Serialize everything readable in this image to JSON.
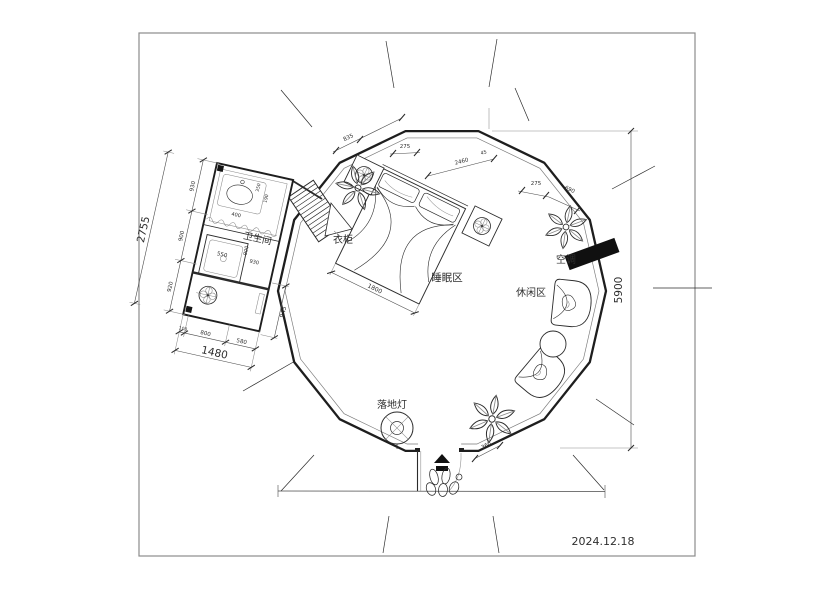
{
  "title": "圆形帐篷民宿平面布置图",
  "date": "2024.12.18",
  "labels": {
    "bathroom": "卫生间",
    "wardrobe": "衣柜",
    "sleeping_area": "睡眠区",
    "leisure_area": "休闲区",
    "air_conditioner": "空调",
    "floor_lamp": "落地灯"
  },
  "dims": {
    "room_height": "5900",
    "bed_width": "1800",
    "door": "360",
    "top": {
      "t1": "835",
      "t2": "275",
      "t3": "2460",
      "t3b": "45",
      "t4": "275",
      "t5": "690"
    },
    "bath": {
      "height_total": "2755",
      "h1": "930",
      "h2": "900",
      "h3": "920",
      "width_total": "1480",
      "w1": "100",
      "w2": "800",
      "w3": "580",
      "right": "945",
      "shower": "550",
      "iv1": "900",
      "iv2": "930",
      "sink": "400",
      "s1": "350",
      "s2": "190"
    }
  },
  "colors": {
    "ink": "#1e1e1e",
    "light": "#8a8a8a",
    "fill": "#ffffff"
  }
}
